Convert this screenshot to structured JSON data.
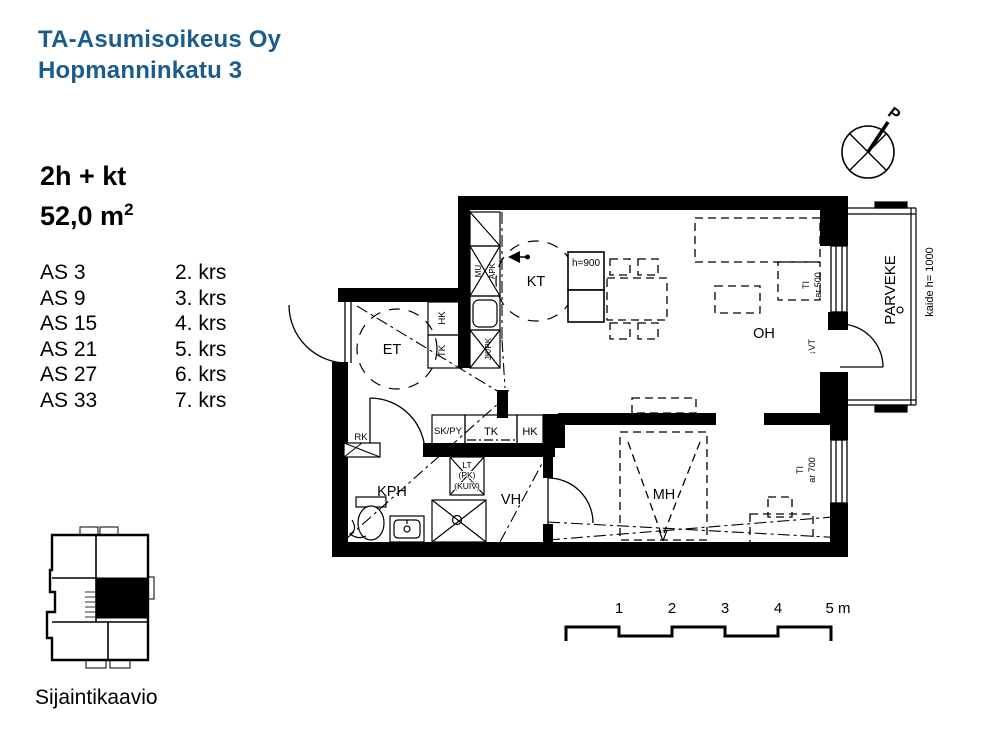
{
  "header": {
    "line1": "TA-Asumisoikeus Oy",
    "line2": "Hopmanninkatu 3",
    "brand_color": "#1a5c8e"
  },
  "apartment": {
    "type": "2h + kt",
    "area": "52,0 m",
    "area_sup": "2"
  },
  "unit_list": [
    {
      "unit": "AS 3",
      "floor": "2. krs"
    },
    {
      "unit": "AS 9",
      "floor": "3. krs"
    },
    {
      "unit": "AS 15",
      "floor": "4. krs"
    },
    {
      "unit": "AS 21",
      "floor": "5. krs"
    },
    {
      "unit": "AS 27",
      "floor": "6. krs"
    },
    {
      "unit": "AS 33",
      "floor": "7. krs"
    }
  ],
  "plan": {
    "rooms": {
      "kt": "KT",
      "et": "ET",
      "oh": "OH",
      "mh": "MH",
      "vh": "VH",
      "kph": "KPH",
      "parveke": "PARVEKE"
    },
    "fixtures": {
      "rk": "RK",
      "hk_et": "HK",
      "tk_et": "TK",
      "sk_py": "SK/PY",
      "tk_row": "TK",
      "hk_row": "HK",
      "mu": "MU",
      "apk": "APK",
      "jk_pk": "JK/PK",
      "lt": "LT",
      "pk": "(PK)",
      "kuiv": "(KUIV)",
      "island_height": "h=900",
      "railing": "kaide h= 1000",
      "ti_1": "TI",
      "ar_500": "ar 500",
      "ti_2": "TI",
      "ar_700": "ar 700",
      "vt": "↓VT",
      "north": "P"
    },
    "scale": {
      "t1": "1",
      "t2": "2",
      "t3": "3",
      "t4": "4",
      "t5": "5 m"
    }
  },
  "location": {
    "caption": "Sijaintikaavio"
  }
}
